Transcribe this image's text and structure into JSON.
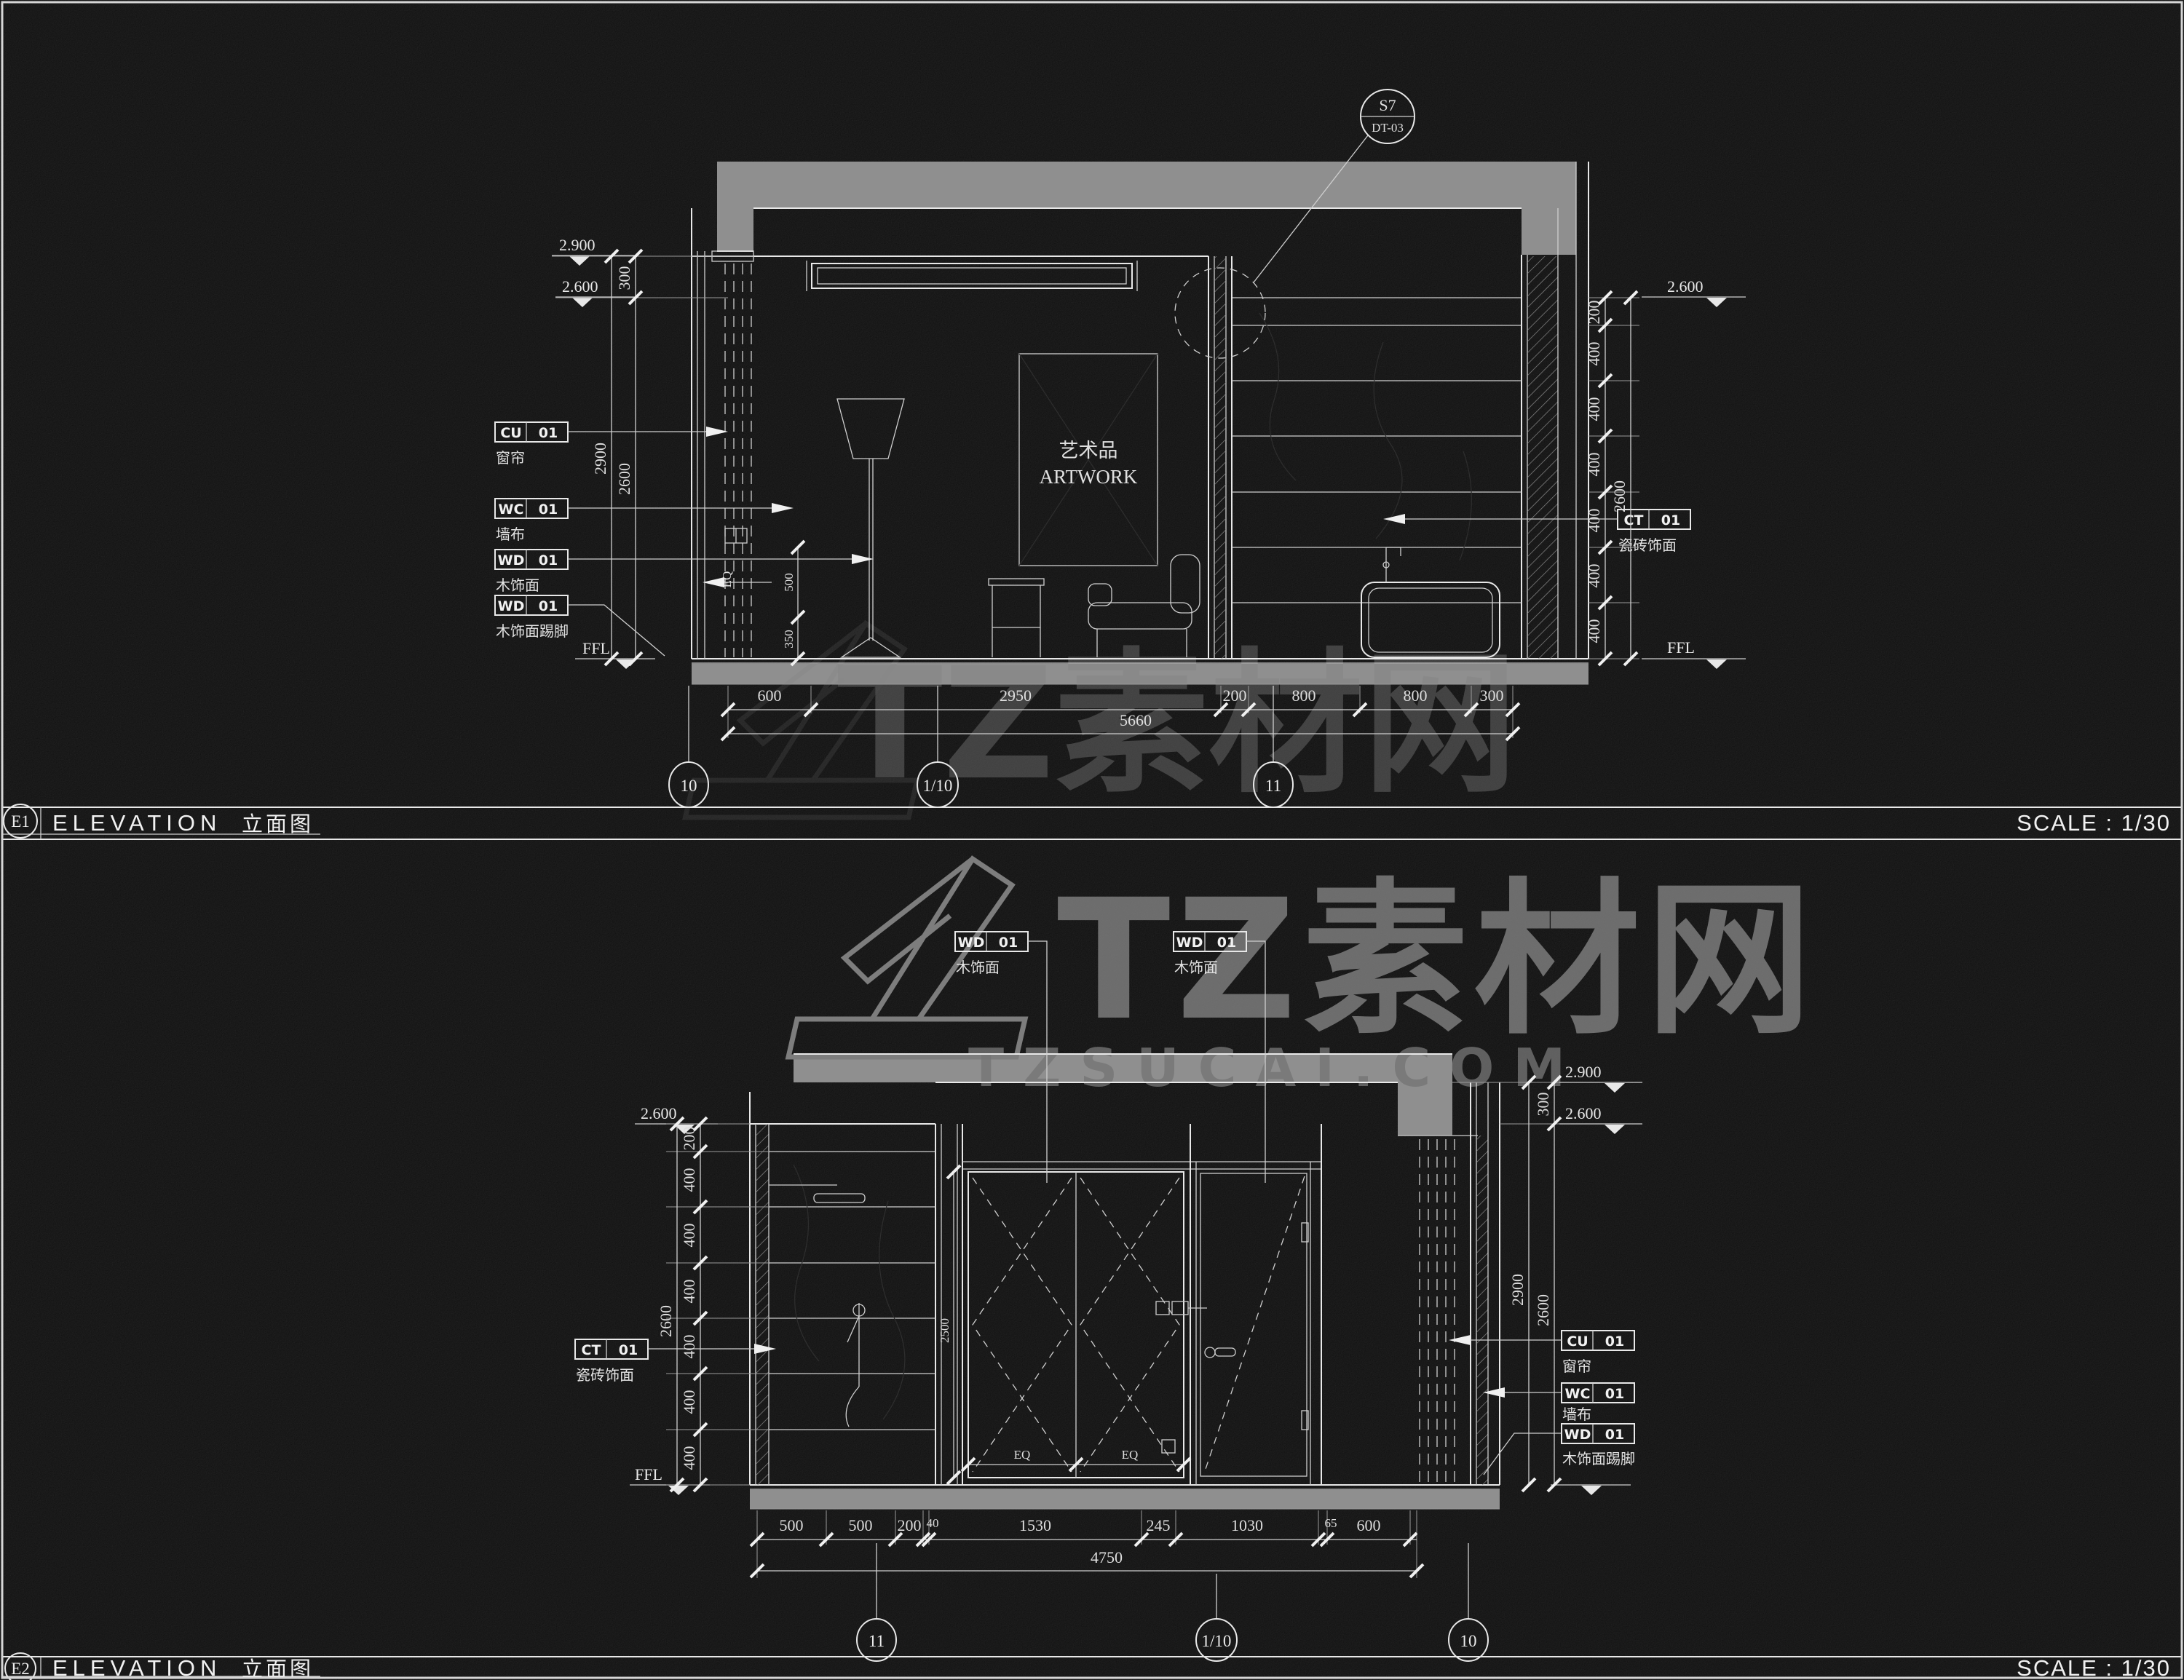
{
  "canvas": {
    "bg": "#070707",
    "line": "#e8e8e8",
    "gray_fill": "#8f8f8f"
  },
  "watermark": {
    "brand": "TZ素材网",
    "domain": "TZSUCAI.COM"
  },
  "e1": {
    "code": "E1",
    "title": "ELEVATION",
    "subtitle": "立面图",
    "scale": "SCALE : 1/30",
    "callout": {
      "top": "S7",
      "bottom": "DT-03"
    },
    "artwork": {
      "cn": "艺术品",
      "en": "ARTWORK"
    },
    "levels": {
      "left_top": "2.900",
      "left_mid": "2.600",
      "right_top": "2.600",
      "ffl_left": "FFL",
      "ffl_right": "FFL"
    },
    "dims": {
      "left_seg": "300",
      "left_inner": "2600",
      "left_outer": "2900",
      "right": [
        "200",
        "400",
        "400",
        "400",
        "400",
        "400",
        "400"
      ],
      "right_total": "2600",
      "bottom": [
        "600",
        "2950",
        "200",
        "800",
        "800",
        "300"
      ],
      "bottom_total": "5660",
      "eq": "EQ",
      "small_a": "500",
      "small_b": "350"
    },
    "materials": [
      {
        "code": "CU",
        "no": "01",
        "desc": "窗帘"
      },
      {
        "code": "WC",
        "no": "01",
        "desc": "墙布"
      },
      {
        "code": "WD",
        "no": "01",
        "desc": "木饰面"
      },
      {
        "code": "WD",
        "no": "01",
        "desc": "木饰面踢脚"
      },
      {
        "code": "CT",
        "no": "01",
        "desc": "瓷砖饰面"
      }
    ],
    "grid": [
      "10",
      "1/10",
      "11"
    ]
  },
  "e2": {
    "code": "E2",
    "title": "ELEVATION",
    "subtitle": "立面图",
    "scale": "SCALE : 1/30",
    "levels": {
      "right_top": "2.900",
      "right_mid": "2.600",
      "left_top": "2.600",
      "ffl_left": "FFL"
    },
    "dims": {
      "left": [
        "200",
        "400",
        "400",
        "400",
        "400",
        "400",
        "400"
      ],
      "left_total": "2600",
      "right_seg": "300",
      "right_inner": "2600",
      "right_outer": "2900",
      "bottom": [
        "500",
        "500",
        "200",
        "40",
        "1530",
        "245",
        "1030",
        "65",
        "600"
      ],
      "bottom_total": "4750",
      "eq": [
        "EQ",
        "EQ"
      ],
      "door_height": "2500"
    },
    "materials": [
      {
        "code": "WD",
        "no": "01",
        "desc": "木饰面"
      },
      {
        "code": "WD",
        "no": "01",
        "desc": "木饰面"
      },
      {
        "code": "CT",
        "no": "01",
        "desc": "瓷砖饰面"
      },
      {
        "code": "CU",
        "no": "01",
        "desc": "窗帘"
      },
      {
        "code": "WC",
        "no": "01",
        "desc": "墙布"
      },
      {
        "code": "WD",
        "no": "01",
        "desc": "木饰面踢脚"
      }
    ],
    "grid": [
      "11",
      "1/10",
      "10"
    ]
  }
}
